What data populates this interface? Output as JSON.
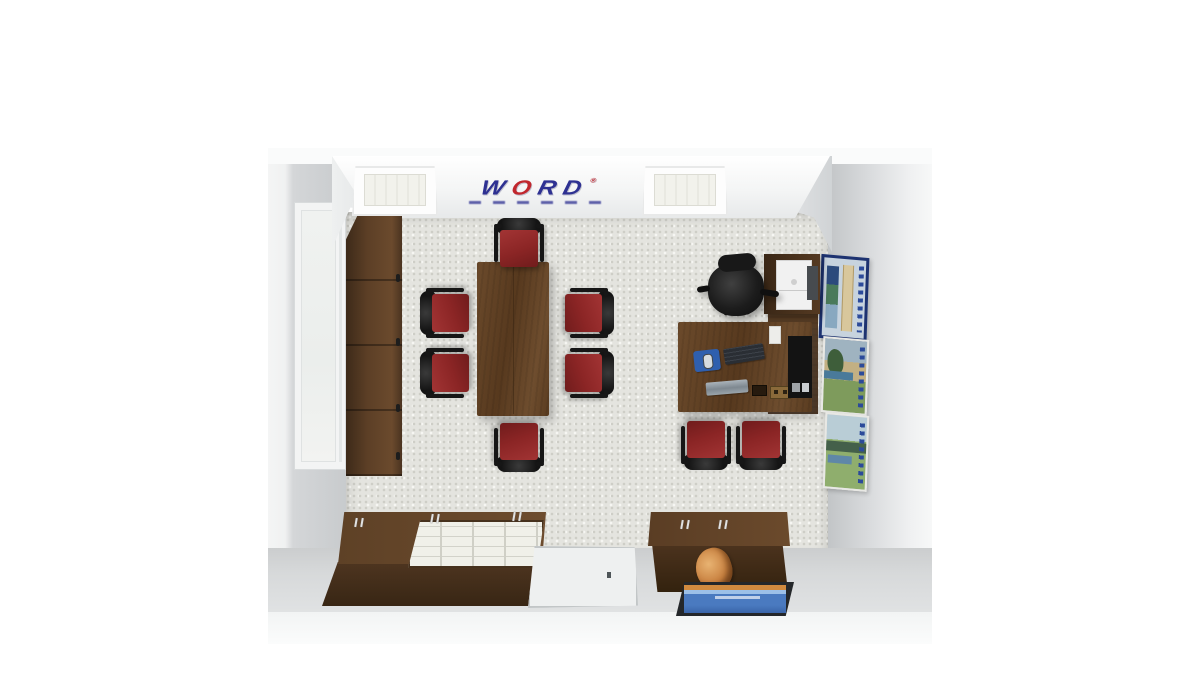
{
  "scene": {
    "description": "3D top-down rendering of a small office showroom with conference table, L-shaped desk and storage credenzas",
    "background_color": "#ffffff"
  },
  "logo": {
    "letters": [
      "W",
      "O",
      "R",
      "D"
    ],
    "registered": "®",
    "letter_colors": {
      "W": "#2e3192",
      "O": "#c1272d",
      "R": "#2e3192",
      "D": "#2e3192"
    },
    "tagline_legible": false
  },
  "room": {
    "wall_color": "#d8dadc",
    "soffit_color": "#f4f5f5",
    "carpet_color": "#e4e4df",
    "entry_floor_color": "#d7d9da",
    "ceiling_light_count": 2,
    "window_wall": "left",
    "poster_wall": "right"
  },
  "furniture": {
    "tall_cabinet": {
      "label": "tall storage cabinet",
      "wood_color": "#5c3f26",
      "sections": 4
    },
    "conference_table": {
      "label": "conference table",
      "wood_color": "#5f4227"
    },
    "conference_chairs": {
      "count": 6,
      "seat_color": "#8b2525",
      "back_color": "#141414"
    },
    "guest_chairs": {
      "count": 2,
      "seat_color": "#8b2525",
      "back_color": "#141414"
    },
    "desk": {
      "label": "L-shaped desk",
      "items": [
        "mouse pad",
        "mouse",
        "keyboard",
        "documents",
        "cable grommet",
        "power outlet",
        "electronics",
        "paper slip"
      ],
      "hutch_items": [
        "printer",
        "side unit"
      ]
    },
    "office_chair": {
      "label": "executive office chair",
      "color": "#1c1c1c"
    },
    "posters": [
      {
        "label": "framed poster - blue monument",
        "colors": [
          "#1d3270",
          "#c7d3de",
          "#d8c79c"
        ]
      },
      {
        "label": "framed poster - green landscape",
        "colors": [
          "#7e9b5c",
          "#c3b083",
          "#9fb3c0"
        ]
      },
      {
        "label": "framed poster - lake landscape",
        "colors": [
          "#8fae6d",
          "#b9cdd6",
          "#44604a"
        ]
      }
    ],
    "credenza_left": {
      "label": "credenza with literature organizer",
      "organizer_color": "#f0f0e9"
    },
    "credenza_right": {
      "label": "low credenza",
      "decor": "orange sculpture"
    },
    "tv": {
      "label": "wall-mounted display",
      "screen_colors": [
        "#d08a3f",
        "#4a7ac0"
      ]
    },
    "floor_mat": {
      "label": "entry floor mat",
      "color": "#eef0f0"
    }
  }
}
